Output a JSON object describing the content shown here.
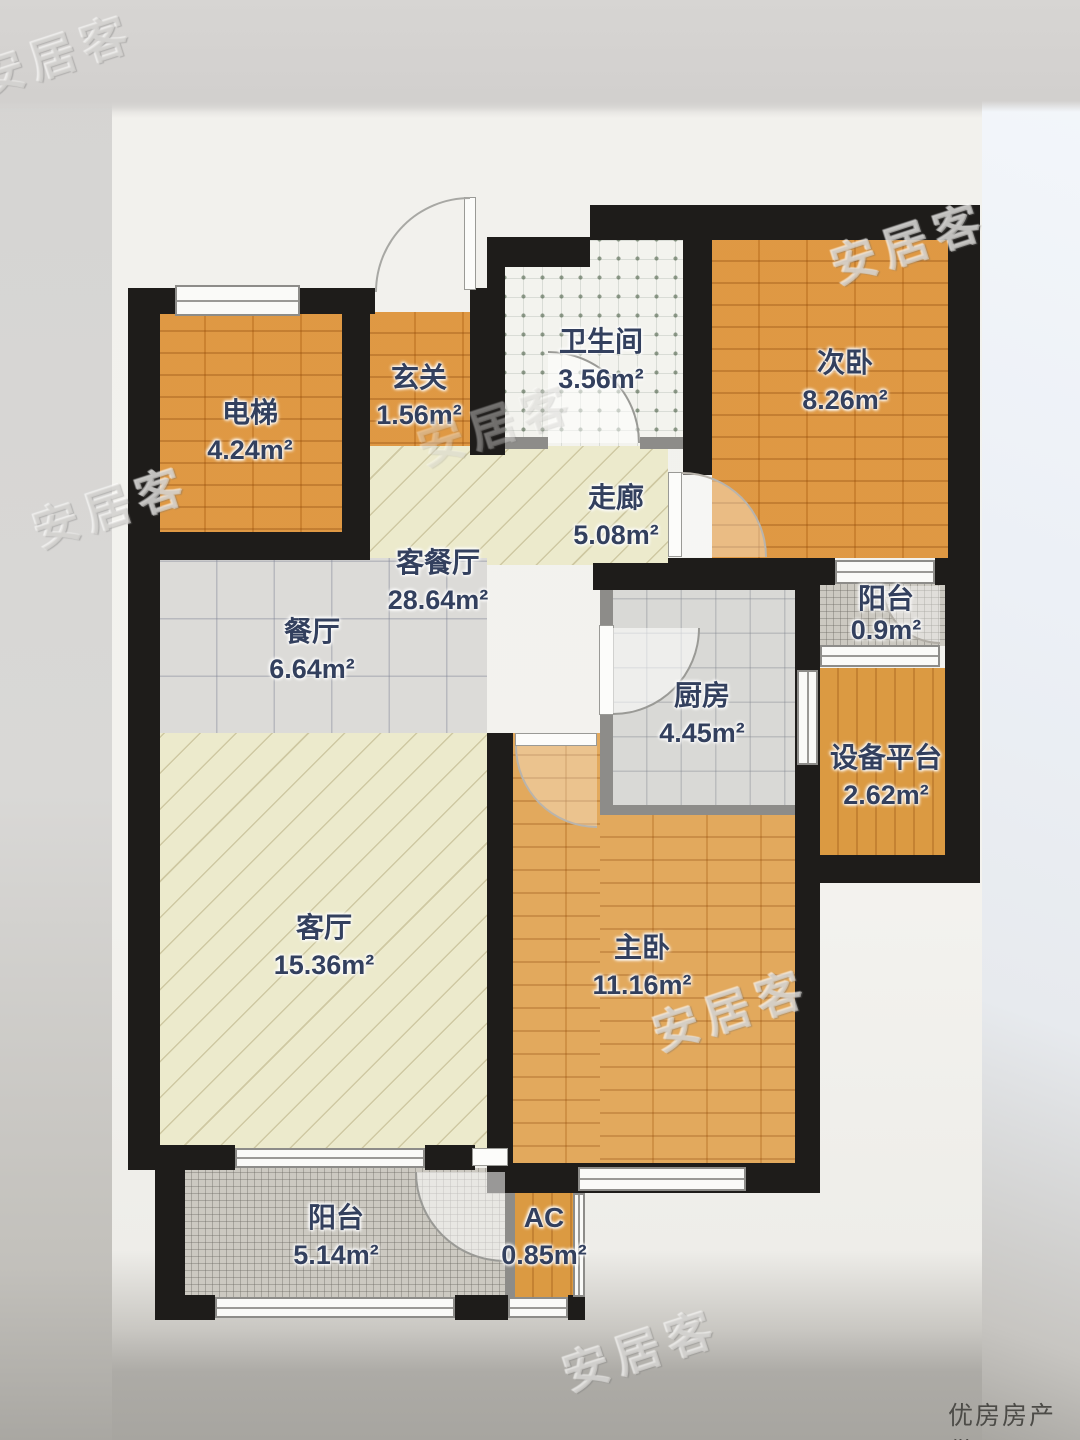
{
  "watermark": {
    "brand": "安居客",
    "credit": "优房房产供图"
  },
  "colors": {
    "wall": "#1e1c1a",
    "partition": "#8d8c89",
    "wood_orange": "#db9038",
    "wood_light": "#dd9f50",
    "floor_pale": "#eceacc",
    "tile_gray": "#dcdbd8",
    "balcony_gray": "#ccc9c1",
    "label_text": "#33405e"
  },
  "rooms": [
    {
      "id": "elevator",
      "name": "电梯",
      "area": "4.24m²"
    },
    {
      "id": "hallway",
      "name": "玄关",
      "area": "1.56m²"
    },
    {
      "id": "bathroom",
      "name": "卫生间",
      "area": "3.56m²"
    },
    {
      "id": "bedroom-second",
      "name": "次卧",
      "area": "8.26m²"
    },
    {
      "id": "corridor",
      "name": "走廊",
      "area": "5.08m²"
    },
    {
      "id": "living-dining",
      "name": "客餐厅",
      "area": "28.64m²"
    },
    {
      "id": "dining",
      "name": "餐厅",
      "area": "6.64m²"
    },
    {
      "id": "kitchen",
      "name": "厨房",
      "area": "4.45m²"
    },
    {
      "id": "balcony-north",
      "name": "阳台",
      "area": "0.9m²"
    },
    {
      "id": "equipment",
      "name": "设备平台",
      "area": "2.62m²"
    },
    {
      "id": "living",
      "name": "客厅",
      "area": "15.36m²"
    },
    {
      "id": "bedroom-master",
      "name": "主卧",
      "area": "11.16m²"
    },
    {
      "id": "balcony-south",
      "name": "阳台",
      "area": "5.14m²"
    },
    {
      "id": "ac",
      "name": "AC",
      "area": "0.85m²"
    }
  ]
}
